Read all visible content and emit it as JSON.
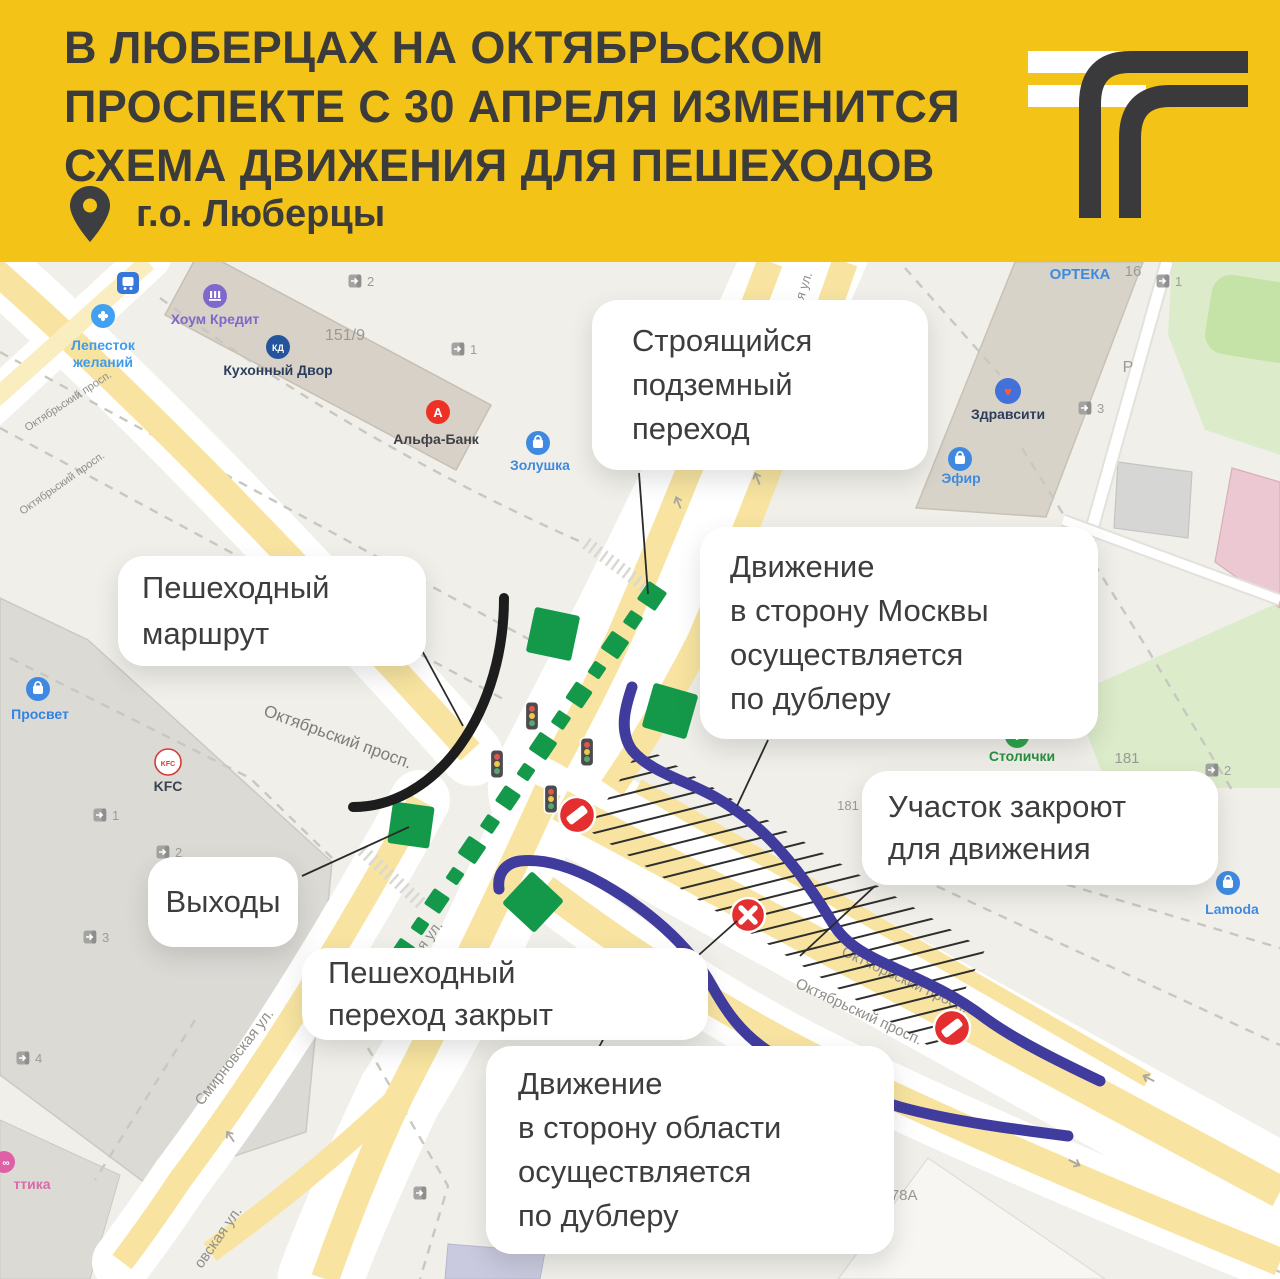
{
  "header": {
    "bg": "#f3c318",
    "title_lines": [
      "В ЛЮБЕРЦАХ НА ОКТЯБРЬСКОМ",
      "ПРОСПЕКТЕ С 30 АПРЕЛЯ ИЗМЕНИТСЯ",
      "СХЕМА ДВИЖЕНИЯ ДЛЯ ПЕШЕХОДОВ"
    ],
    "location": "г.о. Люберцы"
  },
  "colors": {
    "accent_yellow": "#f3c318",
    "pedestrian_route_black": "#1d1d1d",
    "detour_blue": "#403c9e",
    "closed_red": "#e32f2f",
    "exit_green": "#14994a",
    "road_yellow": "#f8e4a0",
    "map_bg": "#f0efe9"
  },
  "callouts": [
    {
      "name": "under-construction-crossing",
      "lines": [
        "Строящийся",
        "подземный",
        "переход"
      ]
    },
    {
      "name": "to-moscow-detour",
      "lines": [
        "Движение",
        "в сторону Москвы",
        "осуществляется",
        "по дублеру"
      ]
    },
    {
      "name": "pedestrian-route",
      "lines": [
        "Пешеходный",
        "маршрут"
      ]
    },
    {
      "name": "closed-section",
      "lines": [
        "Участок закроют",
        "для движения"
      ]
    },
    {
      "name": "exits",
      "lines": [
        "Выходы"
      ]
    },
    {
      "name": "closed-crossing",
      "lines": [
        "Пешеходный",
        "переход закрыт"
      ]
    },
    {
      "name": "to-region-detour",
      "lines": [
        "Движение",
        "в сторону области",
        "осуществляется",
        "по дублеру"
      ]
    }
  ],
  "map": {
    "pois": [
      {
        "name": "home-credit",
        "label": "Хоум Кредит"
      },
      {
        "name": "lepestok",
        "label": "Лепесток",
        "label2": "желаний"
      },
      {
        "name": "kukhonny-dvor",
        "label": "Кухонный Двор"
      },
      {
        "name": "alfa-bank",
        "label": "Альфа-Банк"
      },
      {
        "name": "zolushka",
        "label": "Золушка"
      },
      {
        "name": "orteka",
        "label": "ОРТЕКА"
      },
      {
        "name": "zdravcity",
        "label": "Здравсити"
      },
      {
        "name": "efir",
        "label": "Эфир"
      },
      {
        "name": "stolichki",
        "label": "Столички"
      },
      {
        "name": "lamoda",
        "label": "Lamoda"
      },
      {
        "name": "kfc",
        "label": "KFC"
      },
      {
        "name": "prosvet",
        "label": "Просвет"
      },
      {
        "name": "optika",
        "label": "ттика"
      }
    ],
    "streets": {
      "oktyabrsky": "Октябрьский просп.",
      "oktyabrsky_short": "просп.",
      "smirnovskaya": "Смирновская ул.",
      "smirnovskaya_frag": "овская ул.",
      "street_frag": "я ул."
    },
    "numbers": {
      "n151": "151/9",
      "n16": "16",
      "n181": "181",
      "n181b": "181",
      "n178": "178А",
      "parking": "Р"
    },
    "entrances": [
      "2",
      "1",
      "1",
      "3",
      "2",
      "1",
      "2",
      "3",
      "4"
    ]
  }
}
